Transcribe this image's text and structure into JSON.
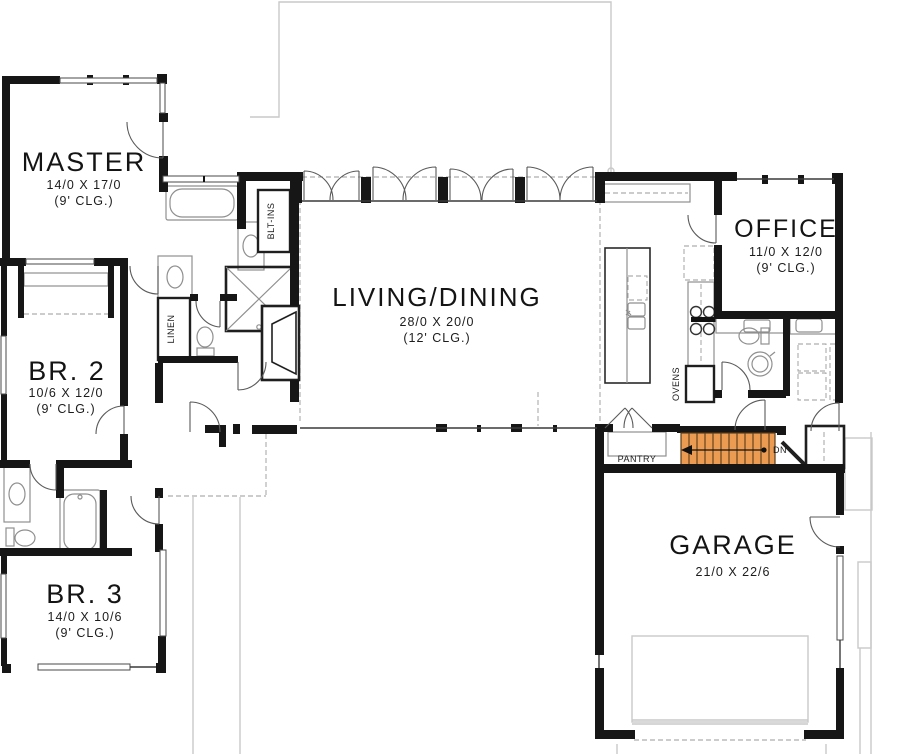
{
  "rooms": {
    "master": {
      "name": "MASTER",
      "dims": "14/0 X 17/0",
      "clg": "(9' CLG.)"
    },
    "br2": {
      "name": "BR. 2",
      "dims": "10/6 X 12/0",
      "clg": "(9' CLG.)"
    },
    "br3": {
      "name": "BR. 3",
      "dims": "14/0 X 10/6",
      "clg": "(9' CLG.)"
    },
    "living": {
      "name": "LIVING/DINING",
      "dims": "28/0 X 20/0",
      "clg": "(12' CLG.)"
    },
    "office": {
      "name": "OFFICE",
      "dims": "11/0 X 12/0",
      "clg": "(9' CLG.)"
    },
    "garage": {
      "name": "GARAGE",
      "dims": "21/0 X 22/6"
    }
  },
  "labels": {
    "pantry": "PANTRY",
    "linen": "LINEN",
    "blt_ins": "BLT-INS",
    "ovens": "OVENS",
    "down": "DN"
  },
  "colors": {
    "stairs_fill": "#EC9B52",
    "stairs_line": "#5a3c16",
    "wall": "#161616"
  }
}
